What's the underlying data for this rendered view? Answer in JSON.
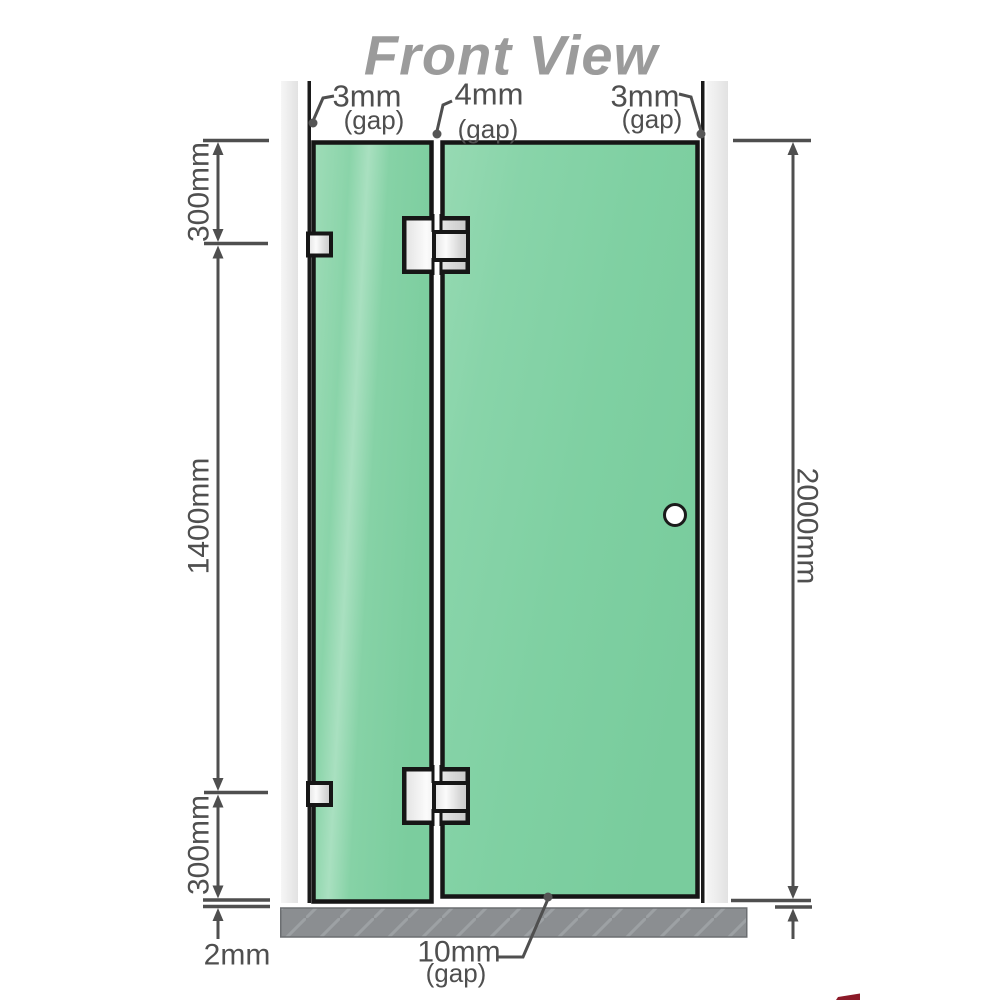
{
  "title": "Front View",
  "colors": {
    "glass": "#7fcfa1",
    "glass_highlight": "#a6dfbf",
    "wall": "#ececec",
    "floor": "#8b8e91",
    "outline": "#1b1b1b",
    "dimension": "#4f4f4f",
    "metal": "#e8e8e8",
    "title_gray": "#9b9b9b",
    "logo_red": "#8c1a28"
  },
  "gap_labels": {
    "top_left": {
      "value": "3mm",
      "suffix": "(gap)"
    },
    "top_middle": {
      "value": "4mm",
      "suffix": "(gap)"
    },
    "top_right": {
      "value": "3mm",
      "suffix": "(gap)"
    },
    "bottom": {
      "value": "10mm",
      "suffix": "(gap)"
    }
  },
  "dimension_labels": {
    "top_segment": "300mm",
    "middle_segment": "1400mm",
    "bottom_segment": "300mm",
    "floor_gap": "2mm",
    "overall_height": "2000mm"
  }
}
